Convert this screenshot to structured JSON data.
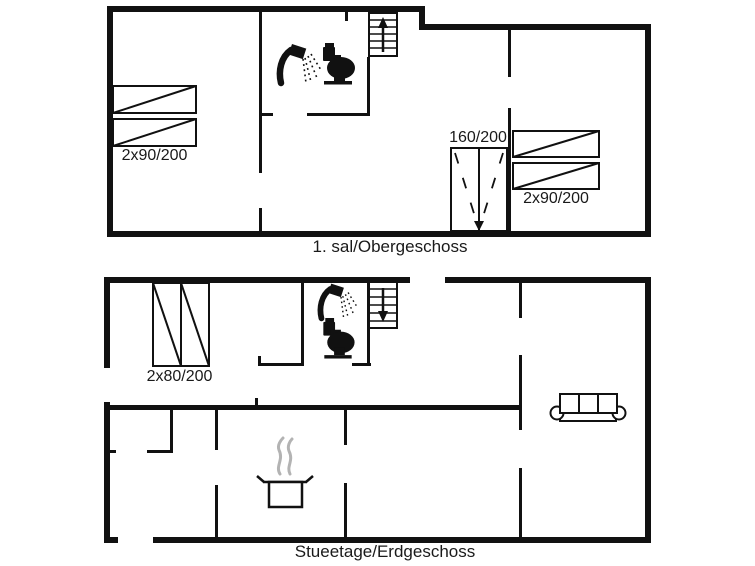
{
  "upper_floor": {
    "caption": "1. sal/Obergeschoss",
    "beds": {
      "left_label": "2x90/200",
      "right_label": "2x90/200"
    },
    "wardrobe_label": "160/200",
    "icons": {
      "shower": "shower-icon",
      "toilet": "toilet-icon",
      "stairs": "stairs-up-icon",
      "wardrobe": "wardrobe-symbol",
      "beds": "double-bed-symbol"
    }
  },
  "ground_floor": {
    "caption": "Stueetage/Erdgeschoss",
    "bed_label": "2x80/200",
    "icons": {
      "shower": "shower-icon",
      "toilet": "toilet-icon",
      "stairs": "stairs-down-icon",
      "sofa": "sofa-icon",
      "stove": "cooking-pot-icon",
      "beds": "double-bed-symbol"
    }
  },
  "colors": {
    "wall": "#111111",
    "background": "#ffffff",
    "steam": "#b3b3b3",
    "text": "#1a1a1a"
  }
}
